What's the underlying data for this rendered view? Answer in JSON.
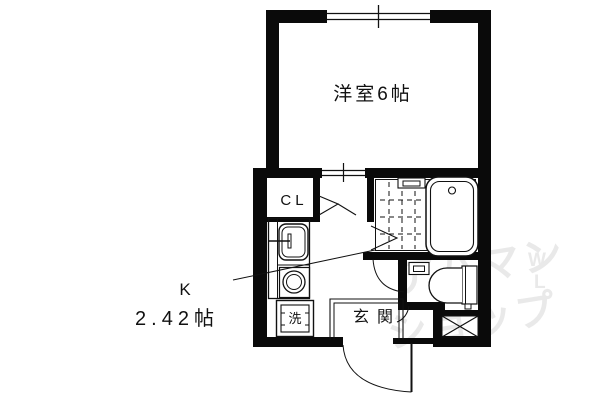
{
  "floorplan": {
    "rooms": {
      "western_room": {
        "label": "洋室6帖"
      },
      "kitchen": {
        "label": "K",
        "size": "2.42帖"
      },
      "closet": {
        "label": "CL"
      },
      "entrance": {
        "label": "玄関"
      },
      "washer": {
        "label": "洗"
      }
    },
    "watermark": {
      "line1": "アパマン",
      "line2": "ショップ",
      "mark1": "W",
      "mark2": "L",
      "color": "#e9e9e9"
    },
    "colors": {
      "wall": "#0a0a0a",
      "background": "#ffffff",
      "line": "#111111"
    }
  }
}
